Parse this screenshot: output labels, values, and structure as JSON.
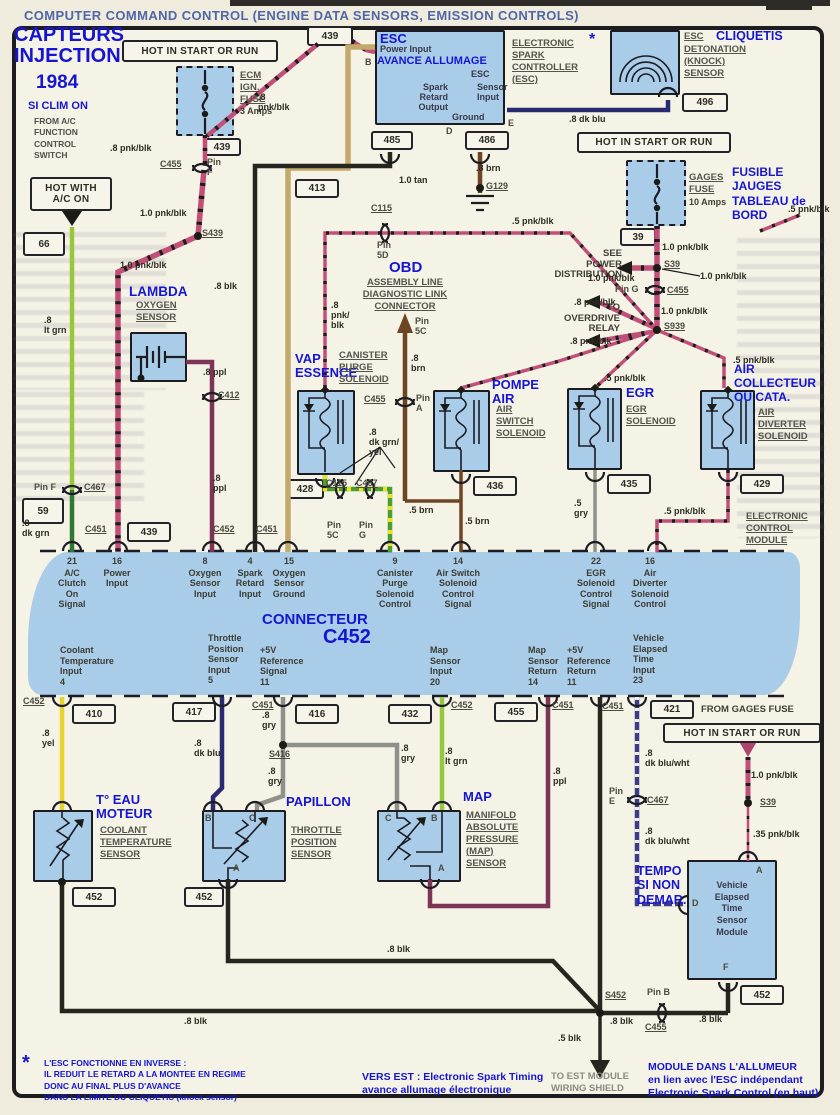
{
  "title": "COMPUTER COMMAND CONTROL (ENGINE DATA SENSORS, EMISSION CONTROLS)",
  "colors": {
    "annotation_blue": "#1616d0",
    "title_blue": "#5066a6",
    "band_fill": "#a9cce9",
    "wire_pink": "#c14f78"
  },
  "fr": {
    "capteurs": "CAPTEURS\nINJECTION",
    "year": "1984",
    "si_clim": "SI CLIM ON",
    "esc": "ESC",
    "avance": "AVANCE ALLUMAGE",
    "star": "*",
    "cliquetis": "CLIQUETIS",
    "fusible": "FUSIBLE\nJAUGES\nTABLEAU de\nBORD",
    "lambda": "LAMBDA",
    "obd": "OBD",
    "vap": "VAP\nESSENCE",
    "pompe": "POMPE\nAIR",
    "egr": "EGR",
    "air_coll": "AIR\nCOLLECTEUR\nOU CATA.",
    "connecteur": "CONNECTEUR",
    "c452": "C452",
    "t_eau": "T° EAU\nMOTEUR",
    "papillon": "PAPILLON",
    "map": "MAP",
    "tempo": "TEMPO\nSI NON\nDEMAR.",
    "note": "L'ESC FONCTIONNE EN INVERSE :\nIL REDUIT LE RETARD A LA MONTEE EN REGIME\nDONC AU FINAL PLUS D'AVANCE\nDANS LA LIMITE DU CLIQUETIS (knock sensor)",
    "vers_est": "VERS EST : Electronic Spark Timing\navance allumage électronique",
    "module_note": "MODULE DANS L'ALLUMEUR\nen lien avec l'ESC indépendant\nElectronic Spark Control (en haut)"
  },
  "en": {
    "hot_start": "HOT IN START OR RUN",
    "hot_ac": "HOT WITH\nA/C ON",
    "from_ac": "FROM A/C\nFUNCTION\nCONTROL\nSWITCH",
    "ecm_fuse": "ECM\nIGN.\nFUSE",
    "ecm_fuse_amps": "3 Amps",
    "gages_fuse": "GAGES\nFUSE",
    "gages_amps": "10 Amps",
    "esc_power": "Power Input",
    "esc_spark": "Spark\nRetard\nOutput",
    "esc_esc": "ESC",
    "esc_sensor": "Sensor\nInput",
    "esc_ground": "Ground",
    "esc_ctrl": "ELECTRONIC\nSPARK\nCONTROLLER\n(ESC)",
    "knock_esc": "ESC",
    "knock_rest": "DETONATION\n(KNOCK)\nSENSOR",
    "see_power": "SEE\nPOWER\nDISTRIBUTION",
    "to_od": "TO\nOVERDRIVE\nRELAY",
    "oxygen": "OXYGEN\nSENSOR",
    "aldl": "ASSEMBLY LINE\nDIAGNOSTIC LINK\nCONNECTOR",
    "canister": "CANISTER\nPURGE\nSOLENOID",
    "air_switch": "AIR\nSWITCH\nSOLENOID",
    "egr_sol": "EGR\nSOLENOID",
    "diverter": "AIR\nDIVERTER\nSOLENOID",
    "ecm": "ELECTRONIC\nCONTROL\nMODULE",
    "coolant": "COOLANT\nTEMPERATURE\nSENSOR",
    "tps": "THROTTLE\nPOSITION\nSENSOR",
    "map_sensor": "MANIFOLD\nABSOLUTE\nPRESSURE\n(MAP)\nSENSOR",
    "vets": "Vehicle\nElapsed\nTime\nSensor\nModule",
    "from_gages": "FROM GAGES FUSE",
    "to_est": "TO EST MODULE\nWIRING SHIELD"
  },
  "band": {
    "top": [
      {
        "n": "21",
        "label": "A/C\nClutch\nOn\nSignal"
      },
      {
        "n": "16",
        "label": "Power\nInput"
      },
      {
        "n": "8",
        "label": "Oxygen\nSensor\nInput"
      },
      {
        "n": "4",
        "label": "Spark\nRetard\nInput"
      },
      {
        "n": "15",
        "label": "Oxygen\nSensor\nGround"
      },
      {
        "n": "9",
        "label": "Canister\nPurge\nSolenoid\nControl"
      },
      {
        "n": "14",
        "label": "Air Switch\nSolenoid\nControl\nSignal"
      },
      {
        "n": "22",
        "label": "EGR\nSolenoid\nControl\nSignal"
      },
      {
        "n": "16",
        "label": "Air\nDiverter\nSolenoid\nControl"
      }
    ],
    "bottom": [
      {
        "label": "Coolant\nTemperature\nInput\n4"
      },
      {
        "label": "Throttle\nPosition\nSensor\nInput\n5"
      },
      {
        "label": "+5V\nReference\nSignal\n11"
      },
      {
        "label": "Map\nSensor\nInput\n20"
      },
      {
        "label": "Map\nSensor\nReturn\n14"
      },
      {
        "label": "+5V\nReference\nReturn\n11"
      },
      {
        "label": "Vehicle\nElapsed\nTime\nInput\n23"
      }
    ]
  },
  "terminals": {
    "t439_top": "439",
    "t439_a": "439",
    "t439_b": "439",
    "t66": "66",
    "t59": "59",
    "t485": "485",
    "t486": "486",
    "t496": "496",
    "t39": "39",
    "t413": "413",
    "t428": "428",
    "t436": "436",
    "t435": "435",
    "t429": "429",
    "t410": "410",
    "t417": "417",
    "t416": "416",
    "t432": "432",
    "t455": "455",
    "t421": "421",
    "t452_a": "452",
    "t452_b": "452",
    "t452_c": "452"
  },
  "conn": {
    "c455_f": "C455",
    "pin_f": "Pin\nF",
    "s439": "S439",
    "pin_f2": "Pin F",
    "c467_f": "C467",
    "c451_1": "C451",
    "c452_1": "C452",
    "c451_2": "C451",
    "c412": "C412",
    "c115_5d": "C115",
    "pin_5d": "Pin\n5D",
    "pin_5c": "Pin\n5C",
    "c455_a": "C455",
    "pin_a": "Pin\nA",
    "c115_b": "C115",
    "c467_b": "C467",
    "pin_5c2": "Pin\n5C",
    "pin_g2": "Pin\nG",
    "g129": "G129",
    "s39": "S39",
    "pin_g": "Pin G",
    "c455_g": "C455",
    "s939": "S939",
    "c452_2": "C452",
    "c451_3": "C451",
    "s416": "S416",
    "c452_3": "C452",
    "c451_4": "C451",
    "c451_5": "C451",
    "pin_e": "Pin\nE",
    "c467_e": "C467",
    "s39_b": "S39",
    "s452": "S452",
    "pin_b": "Pin B",
    "c455_b": "C455"
  },
  "wires": {
    "pnk8_a": ".8 pnk/blk",
    "pnk8_b": ".8\npnk/blk",
    "pnk10_a": "1.0 pnk/blk",
    "pnk10_b": "1.0 pnk/blk",
    "blk8_a": ".8 blk",
    "ltgrn_a": ".8\nlt grn",
    "ppl_a": ".8 ppl",
    "ppl_b": ".8\nppl",
    "dkgrn": ".8\ndk grn",
    "tan10": "1.0 tan",
    "brn8_a": ".8 brn",
    "pnk5_a": ".5 pnk/blk",
    "pnk8_c": ".8\npnk/\nblk",
    "brn8_b": ".8\nbrn",
    "dkblu_a": ".8 dk blu",
    "pnk10_c": "1.0 pnk/blk",
    "pnk10_d": "1.0 pnk/blk",
    "pnk10_e": "1.0 pnk/blk",
    "pnk8_d": ".8 pnk/blk",
    "pnk8_e": ".8 pnk/blk",
    "pnk10_f": "1.0 pnk/blk",
    "pnk5_b": ".5 pnk/blk",
    "pnk5_c": ".5 pnk/blk",
    "pnk5_tr": ".5 pnk/blk",
    "grnyel": ".8\ndk grn/\nyel",
    "brn5_a": ".5 brn",
    "brn5_b": ".5 brn",
    "gry5": ".5\ngry",
    "pnk5_d": ".5 pnk/blk",
    "yel8": ".8\nyel",
    "dkblu_b": ".8\ndk blu",
    "gry_a": ".8\ngry",
    "gry_b": ".8\ngry",
    "gry_c": ".8\ngry",
    "ltgrn_b": ".8\nlt grn",
    "ppl_c": ".8\nppl",
    "dbw_a": ".8\ndk blu/wht",
    "dbw_b": ".8\ndk blu/wht",
    "pnk10_g": "1.0 pnk/blk",
    "pnk35": ".35 pnk/blk",
    "blk8_b": ".8 blk",
    "blk8_c": ".8 blk",
    "blk8_d": ".8 blk",
    "blk8_e": ".8 blk",
    "blk5": ".5 blk"
  },
  "pins": {
    "a": "A",
    "b": "B",
    "c": "C",
    "d": "D",
    "e": "E",
    "f": "F",
    "g": "G"
  }
}
